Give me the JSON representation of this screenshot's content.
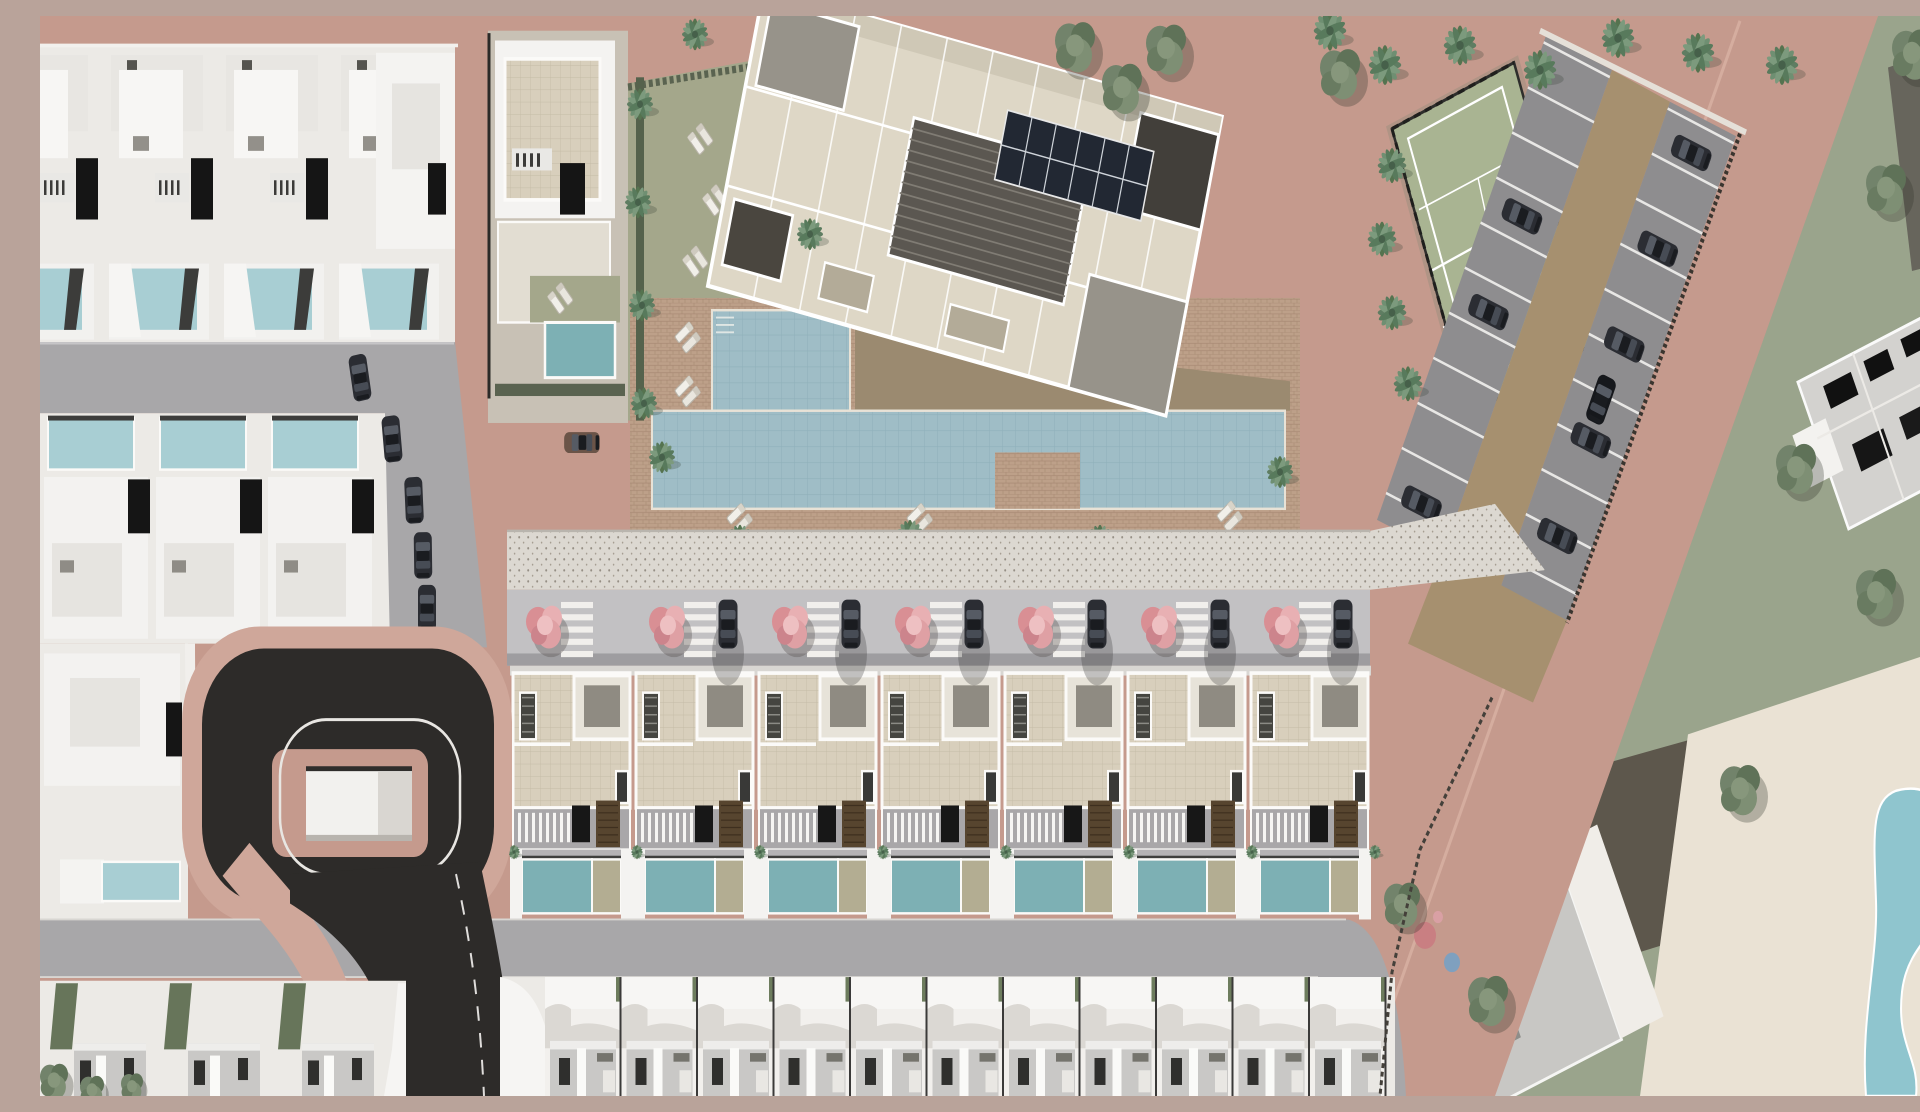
{
  "scene": {
    "type": "aerial-3d-render",
    "title": "Residential development master plan - aerial 3D render",
    "description": "Top-down 3D architectural render of a coastal residential development: rows of white townhouses with private teal pools, a central row of seven beige-roofed villas fronted by pink flowering trees and parked cars, a large tilted apartment block with rooftop solar panels, a communal lagoon pool with brick sun deck and palm trees, a lawn with sun loungers, a fenced tennis court, an angled parking lot with dark cars, a black asphalt cul-de-sac loop with a white utility building on its island, dusty-pink perimeter roads, and neighbouring grey apartment buildings with a free-form pool at the lower right."
  },
  "palette": {
    "road_pink": "#c59a8d",
    "curb_pink": "#cfa79a",
    "asphalt": "#2d2b29",
    "street_gray": "#a8a7a9",
    "driveway_gray": "#c2c1c3",
    "stall_gray": "#8e8d8f",
    "aisle_tan": "#a6906f",
    "plot_white": "#eceae6",
    "building_white": "#f4f3f1",
    "roof_gray": "#c9c8c6",
    "roof_beige": "#ded7c6",
    "tile_beige": "#d8cfbc",
    "pool_private": "#7db0b4",
    "pool_left": "#a8ced3",
    "pool_communal": "#9fbdc6",
    "pool_resort": "#8fc5ce",
    "deck_brick": "#bda089",
    "deck_white": "#eae2d4",
    "lawn_green": "#a4a78b",
    "lawn_east": "#9aa48c",
    "tennis_green": "#a9b492",
    "palm_green": "#5f7d62",
    "tree_green": "#6d7f66",
    "hedge_dark": "#5a6350",
    "flower_pink": "#dfa0a4",
    "car_dark": "#2b2d33",
    "car_brown": "#6b5448",
    "garage_black": "#151515",
    "solar_dark": "#222833",
    "plot_dark": "#67655c",
    "pergola_gray": "#5b5751",
    "walk_dots": "#dcd8d1"
  },
  "counts": {
    "middle_row_townhouses": 7,
    "middle_row_flowering_trees": 7,
    "middle_row_driveway_cars": 6,
    "bottom_row_townhouses": 11,
    "bottom_left_units": 3,
    "upper_left_units_row1": 4,
    "upper_left_units_row2": 3,
    "street_parked_cars": 5,
    "parking_stall_lines_per_row": 11,
    "parking_cars": 9,
    "lawn_lounger_pairs": 4,
    "deck_lounger_pairs": 5,
    "tennis_courts": 1,
    "communal_pools": 1,
    "playground_discs": 3
  },
  "regions": {
    "apartment_building": "tilted beige apartment block with rooftop solar array and pergola",
    "communal_pool": "L-shaped communal pool with brick deck and loungers",
    "lawn": "communal lawn with sun loungers and palms",
    "tennis_court": "fenced green tennis court",
    "parking": "angled parking lot with tan drive aisle",
    "cul_de_sac": "black asphalt turning loop with white marking and island utility building",
    "middle_villa_row": "seven villas with roof terraces, balconies and private pools",
    "bottom_villa_row": "eleven white villas seen from behind",
    "left_townhouse_block": "rows of white townhouses with light-teal pools",
    "east_neighbourhood": "pink diagonal road, lawns, grey apartment buildings, free-form pool"
  }
}
